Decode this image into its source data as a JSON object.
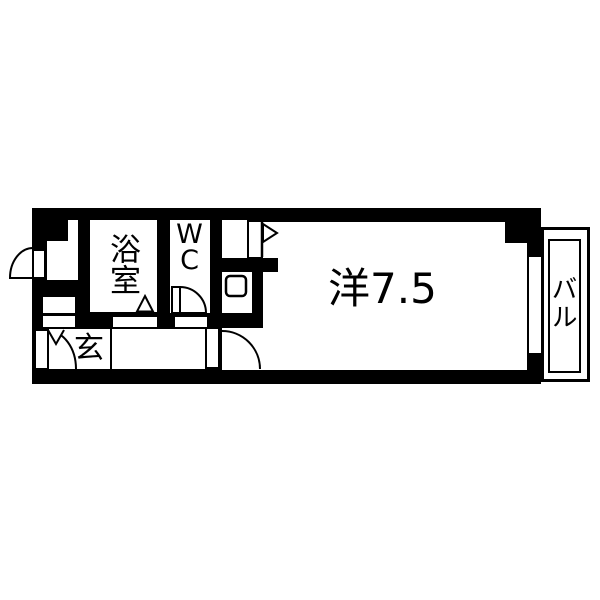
{
  "title": "apartment-floor-plan",
  "colors": {
    "wall": "#000000",
    "floor": "#ffffff",
    "line": "#000000"
  },
  "rooms": {
    "bath": {
      "label": "浴室"
    },
    "toilet": {
      "label": "WC"
    },
    "entrance": {
      "label": "玄"
    },
    "main": {
      "label": "洋7.5"
    },
    "balcony": {
      "label": "バル"
    }
  },
  "symbols": {
    "door_arcs": [
      "entrance-outward-door",
      "genkan-door",
      "wc-door",
      "main-room-door"
    ],
    "fixtures": [
      "sink-square",
      "flag-marker",
      "bath-fold-door-triangle",
      "hinge-v-marker"
    ]
  }
}
